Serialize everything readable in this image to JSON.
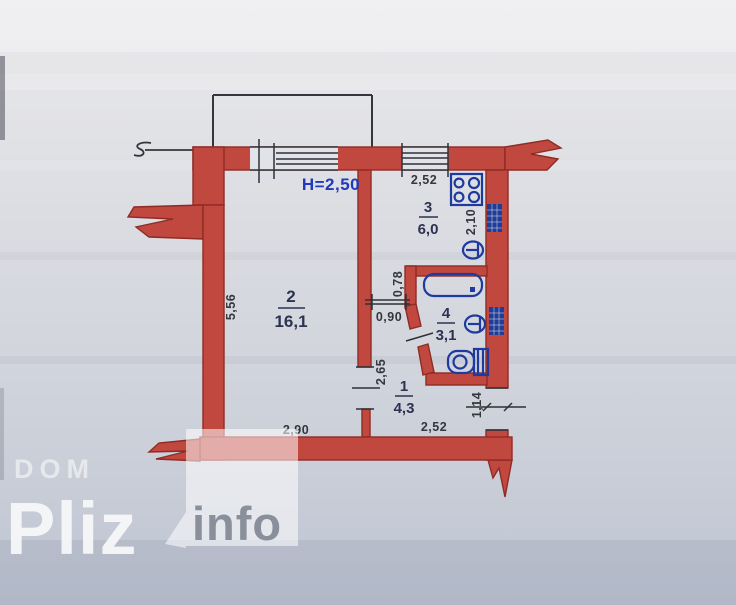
{
  "photo": {
    "plan": {
      "ceiling_height_label": "H=2,50",
      "rooms": [
        {
          "id": "room-2",
          "number": "2",
          "area": "16,1"
        },
        {
          "id": "room-3",
          "number": "3",
          "area": "6,0"
        },
        {
          "id": "room-4",
          "number": "4",
          "area": "3,1"
        },
        {
          "id": "room-1",
          "number": "1",
          "area": "4,3"
        }
      ],
      "dimensions": {
        "kitchen_width_top": "2,52",
        "kitchen_depth": "2,10",
        "room2_depth": "5,56",
        "bath_wall_offset": "0,78",
        "kitchen_door_width": "0,90",
        "hall_depth": "2,65",
        "room2_width": "2,90",
        "hall_width": "2,52",
        "entry_door_width": "1,14"
      },
      "colors": {
        "wall": "#c1483f",
        "wall_outline": "#8f2b25",
        "annotation_blue": "#2139bd",
        "fixture_blue": "#1e3a9e",
        "line": "#2f3038"
      }
    },
    "watermark": {
      "brand_top": "DOM",
      "brand_main": "Pliz",
      "badge": "info"
    }
  }
}
